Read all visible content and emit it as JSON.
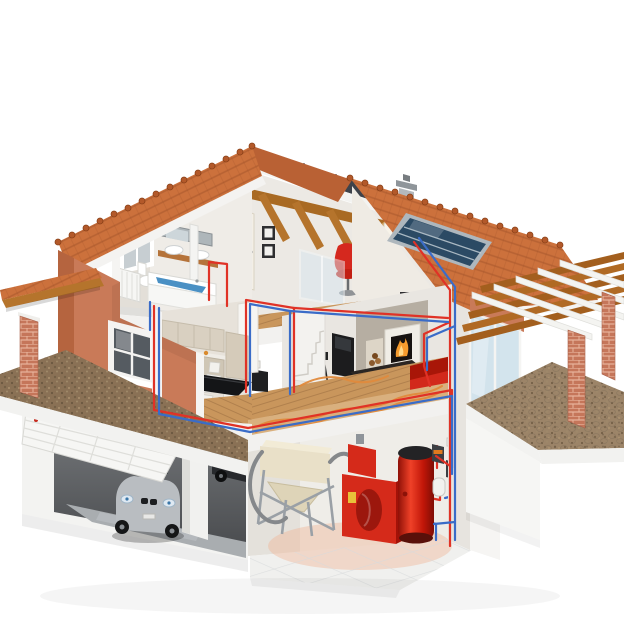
{
  "meta": {
    "title": "Cutaway house with solar and pellet heating system",
    "kind": "3d-isometric-illustration",
    "background": "#ffffff"
  },
  "palette": {
    "background": "#ffffff",
    "roof-tile": "#cc713c",
    "roof-tile-dark": "#a85527",
    "roof-back": "#3e434b",
    "stucco": "#c97a58",
    "stucco-dark": "#b5643f",
    "interior-wall": "#efece7",
    "wood-floor": "#c9965c",
    "wood-beam": "#b5742c",
    "solar-panel": "#2b4a64",
    "pipe-hot": "#e03226",
    "pipe-cold": "#3a6cc8",
    "heating-coil": "#e08a3c",
    "equipment-red": "#d52a1a",
    "sofa-red": "#d2291b",
    "chair-red": "#d5281e",
    "hopper-cream": "#e9e0c8",
    "water-blue": "#4a90c4",
    "fire-orange": "#f59b2e",
    "car-silver": "#b9bdc1",
    "gravel": "#8a7155",
    "cobblestone": "#9c8468",
    "brick": "#c5765a"
  },
  "scene": {
    "description": "Isometric cutaway of a two-story house with basement: solar collector on the roof feeds red (hot) and blue (cold) pipes down to a basement boiler room with pellet boiler, hot water tank and pellet hopper; underfloor heating coils, radiators, bathroom, kitchen-dining, living room with fireplace, attic lounge, garage with car, pergola patio and porch.",
    "components": [
      {
        "name": "roof-left",
        "label": "Tiled gable roof (left wing)"
      },
      {
        "name": "roof-right",
        "label": "Tiled main roof with solar collector"
      },
      {
        "name": "solar-panel",
        "label": "Solar thermal collector"
      },
      {
        "name": "chimney",
        "label": "Metal chimney"
      },
      {
        "name": "attic-lounge",
        "label": "Attic lounge with red chair and floor lamp"
      },
      {
        "name": "bathroom",
        "label": "Bathroom with bathtub, sinks, toilet, radiator"
      },
      {
        "name": "kitchen-dining",
        "label": "Kitchen with dining table"
      },
      {
        "name": "living-room",
        "label": "Living room with fireplace, TV, sofa, stairs"
      },
      {
        "name": "garage",
        "label": "Garage with sectional door and car"
      },
      {
        "name": "boiler-room",
        "label": "Basement boiler room"
      },
      {
        "name": "pellet-boiler",
        "label": "Red pellet boiler"
      },
      {
        "name": "hot-water-tank",
        "label": "Red hot water storage tank"
      },
      {
        "name": "pellet-hopper",
        "label": "Pellet hopper with feed hose"
      },
      {
        "name": "pumps",
        "label": "Wall-mounted circulation pumps"
      },
      {
        "name": "expansion-vessel",
        "label": "Expansion vessel"
      },
      {
        "name": "underfloor-heating",
        "label": "Underfloor heating coils"
      },
      {
        "name": "pipes-hot",
        "label": "Hot supply piping (red)"
      },
      {
        "name": "pipes-cold",
        "label": "Cold return piping (blue)"
      },
      {
        "name": "pergola",
        "label": "Pergola over cobblestone patio"
      },
      {
        "name": "porch",
        "label": "Porch with brick pillar"
      },
      {
        "name": "gravel-yard",
        "label": "Gravel yard band"
      }
    ]
  }
}
